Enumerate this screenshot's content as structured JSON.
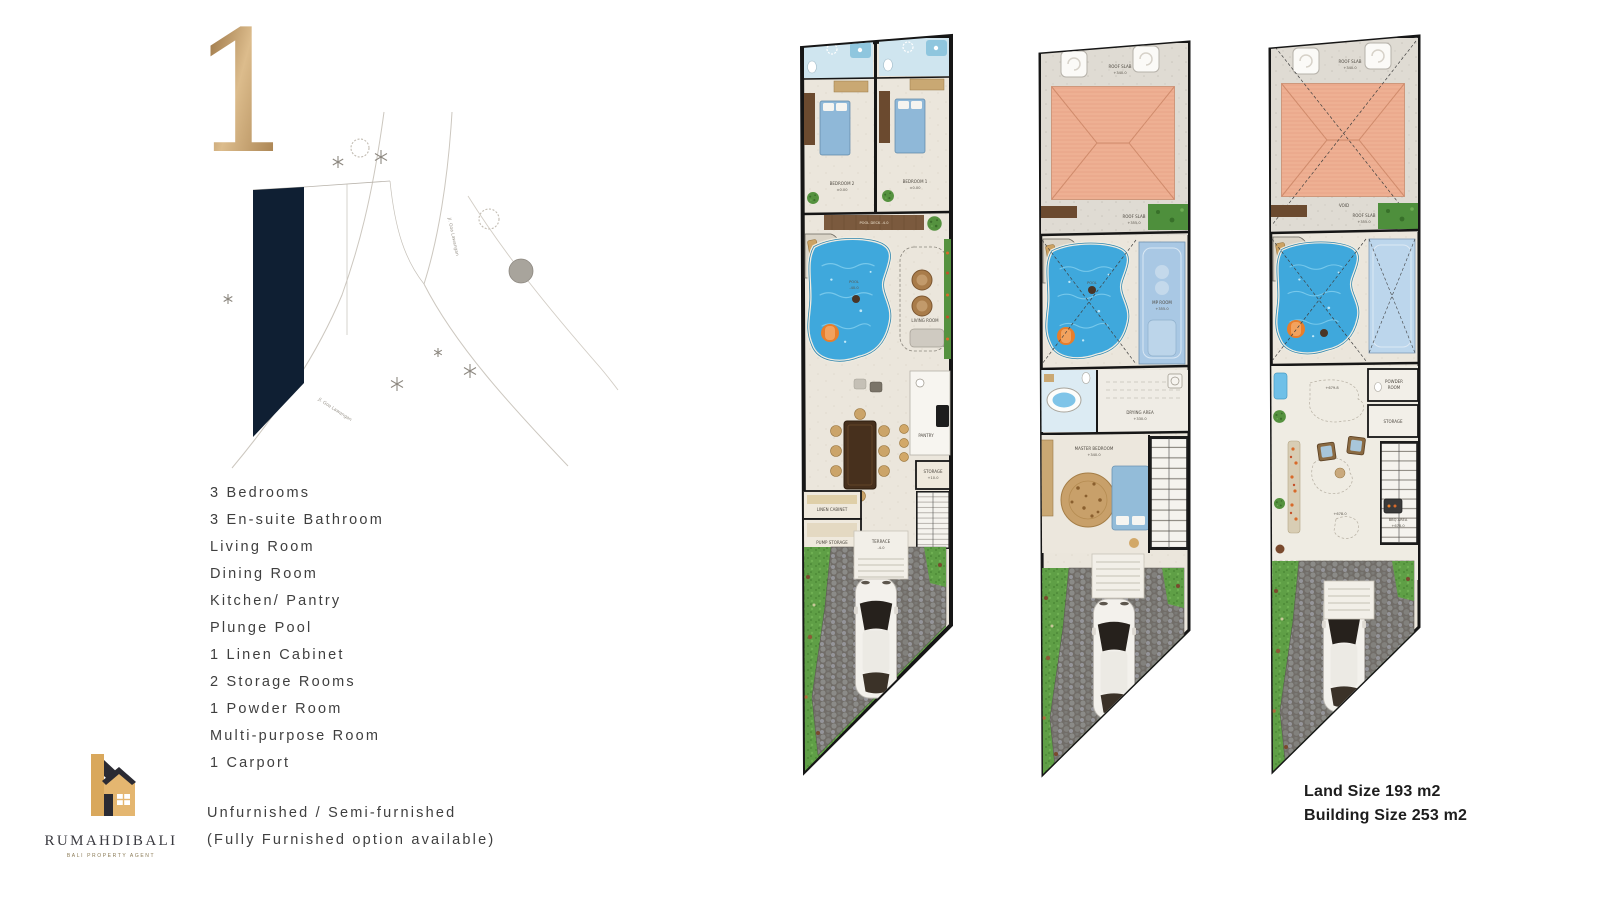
{
  "page_number": "1",
  "site_plan": {
    "road_label_1": "Jl. Goa Lawangan",
    "road_label_2": "Jl. Goa Lawangan"
  },
  "features": [
    "3 Bedrooms",
    "3 En-suite Bathroom",
    "Living Room",
    "Dining Room",
    "Kitchen/ Pantry",
    "Plunge Pool",
    "1 Linen Cabinet",
    "2 Storage Rooms",
    "1 Powder Room",
    "Multi-purpose Room",
    "1 Carport"
  ],
  "furnishing": [
    "Unfurnished / Semi-furnished",
    "(Fully Furnished option available)"
  ],
  "logo": {
    "name": "RUMAHDIBALI",
    "tagline": "BALI PROPERTY AGENT"
  },
  "size_info": {
    "land": "Land Size 193 m2",
    "building": "Building Size 253 m2"
  },
  "colors": {
    "accent_gold": "#c49a5f",
    "plot_navy": "#0f1f33",
    "pool_blue": "#3fa8dc",
    "roof_salmon": "#eeb093",
    "grass_green": "#5f9f46",
    "text": "#3f3f3f"
  },
  "plans": [
    {
      "title": "ground-floor",
      "labels": {
        "bedroom2": "BEDROOM 2",
        "bedroom2_lvl": "±0.00",
        "bedroom1": "BEDROOM 1",
        "bedroom1_lvl": "±0.00",
        "pool_deck": "POOL DECK -4.0",
        "sun_lounge": "SUN LOUNGE",
        "pool": "POOL",
        "pool_lvl": "-40.0",
        "living": "LIVING ROOM",
        "pantry": "PANTRY",
        "linen": "LINEN CABINET",
        "pump": "PUMP STORAGE",
        "pump_lvl": "+10.0",
        "storage": "STORAGE",
        "storage_lvl": "+10.0",
        "terrace": "TERRACE",
        "terrace_lvl": "-4.0"
      }
    },
    {
      "title": "second-floor",
      "labels": {
        "roof_slab": "ROOF SLAB",
        "roof_slab_lvl": "+340.0",
        "roof_slab2": "ROOF SLAB",
        "roof_slab2_lvl": "+355.0",
        "sun_lounge": "SUN LOUNGE",
        "pool": "POOL",
        "mp_room": "MP ROOM",
        "mp_room_lvl": "+355.0",
        "drying": "DRYING AREA",
        "drying_lvl": "+330.0",
        "master": "MASTER BEDROOM",
        "master_lvl": "+340.0"
      }
    },
    {
      "title": "roof",
      "labels": {
        "roof_slab": "ROOF SLAB",
        "roof_slab_lvl": "+340.0",
        "void": "VOID",
        "roof_slab2": "ROOF SLAB",
        "roof_slab2_lvl": "+355.0",
        "sun_lounge": "SUN LOUNGE",
        "powder1": "POWDER",
        "powder2": "ROOM",
        "storage": "STORAGE",
        "lvl_high": "+679.8",
        "lvl_low": "+678.0",
        "bbq": "BBQ AREA",
        "bbq_lvl": "+678.0"
      }
    }
  ]
}
